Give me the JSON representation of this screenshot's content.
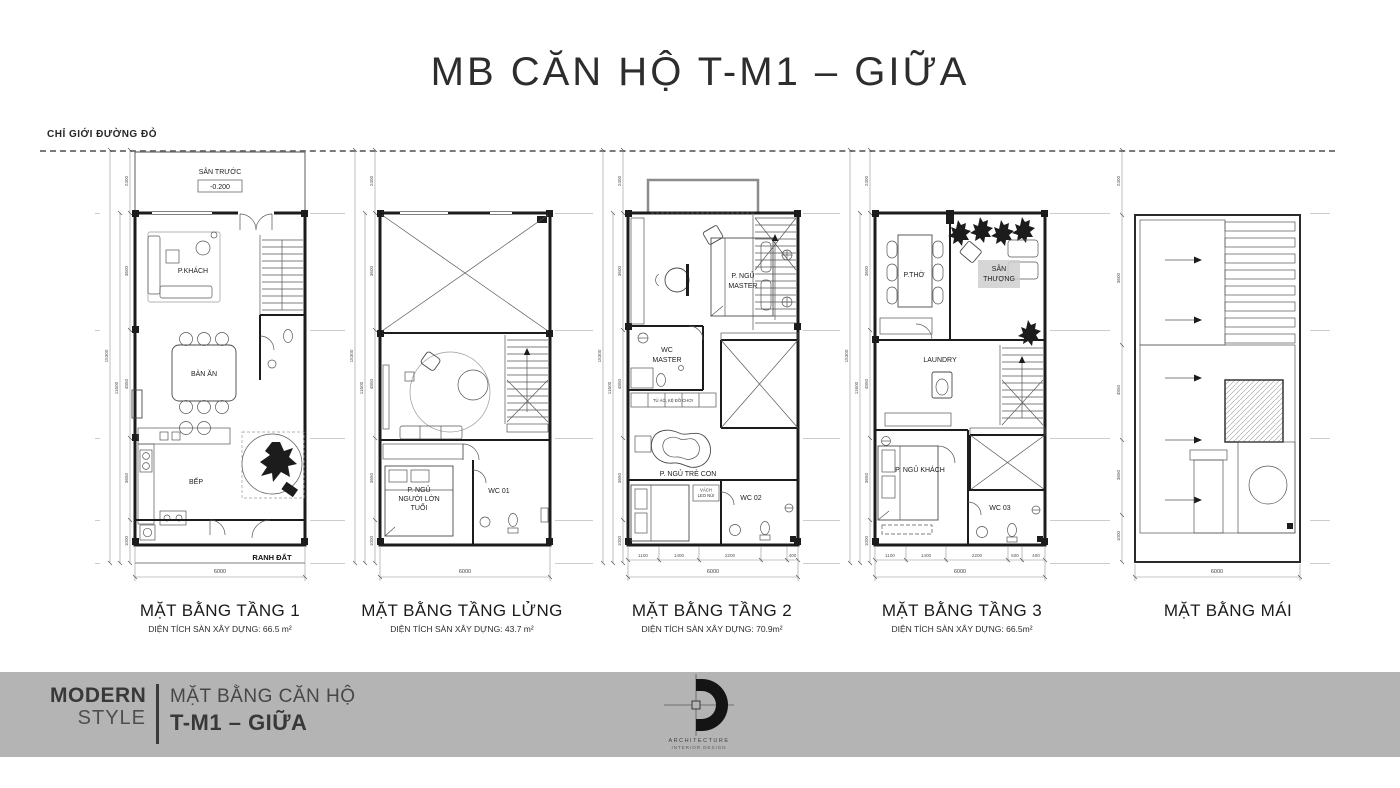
{
  "title": "MB CĂN HỘ T-M1 – GIỮA",
  "red_boundary_label": "CHỈ GIỚI ĐƯỜNG ĐỎ",
  "dims": {
    "seg": [
      "2400",
      "3600",
      "4850",
      "3650",
      "1000"
    ],
    "total_outer": "15300",
    "total_inner": "11600",
    "width_total": "6000",
    "t2_bottom": [
      "1100",
      "1400",
      "2200",
      "400"
    ],
    "t3_bottom": [
      "1100",
      "1400",
      "2200",
      "500",
      "400"
    ]
  },
  "plans": {
    "t1": {
      "label": "MẶT BẰNG TẦNG 1",
      "area": "DIỆN TÍCH SÀN XÂY DỰNG: 66.5 m²",
      "front_yard": "SÂN TRƯỚC",
      "level": "-0.200",
      "living": "P.KHÁCH",
      "dining": "BÀN ĂN",
      "kitchen": "BẾP",
      "boundary": "RANH ĐẤT"
    },
    "mezz": {
      "label": "MẶT BẰNG TẦNG LỬNG",
      "area": "DIỆN TÍCH SÀN XÂY DỰNG: 43.7 m²",
      "bed1": "P. NGỦ",
      "bed2": "NGƯỜI LỚN",
      "bed3": "TUỔI",
      "wc": "WC 01"
    },
    "t2": {
      "label": "MẶT BẰNG TẦNG 2",
      "area": "DIỆN TÍCH SÀN XÂY DỰNG: 70.9m²",
      "master1": "P. NGỦ",
      "master2": "MASTER",
      "wcm1": "WC",
      "wcm2": "MASTER",
      "shelf": "TỦ ÁO, KỆ ĐỒ CHƠI",
      "kids": "P. NGỦ TRẺ CON",
      "climb1": "VÁCH",
      "climb2": "LEO NÚI",
      "wc": "WC 02"
    },
    "t3": {
      "label": "MẶT BẰNG TẦNG 3",
      "area": "DIỆN TÍCH SÀN XÂY DỰNG: 66.5m²",
      "worship": "P.THỜ",
      "terrace1": "SÂN",
      "terrace2": "THƯỢNG",
      "laundry": "LAUNDRY",
      "guest": "P. NGỦ KHÁCH",
      "wc": "WC 03"
    },
    "roof": {
      "label": "MẶT BẰNG  MÁI"
    }
  },
  "footer": {
    "brand_top": "MODERN",
    "brand_bottom": "STYLE",
    "subtitle": "MẶT BẰNG CĂN HỘ",
    "title": "T-M1 – GIỮA",
    "logo_line1": "ARCHITECTURE",
    "logo_line2": "INTERIOR DESIGN"
  },
  "colors": {
    "band": "#b4b4b4",
    "ink": "#1c1c1c"
  }
}
